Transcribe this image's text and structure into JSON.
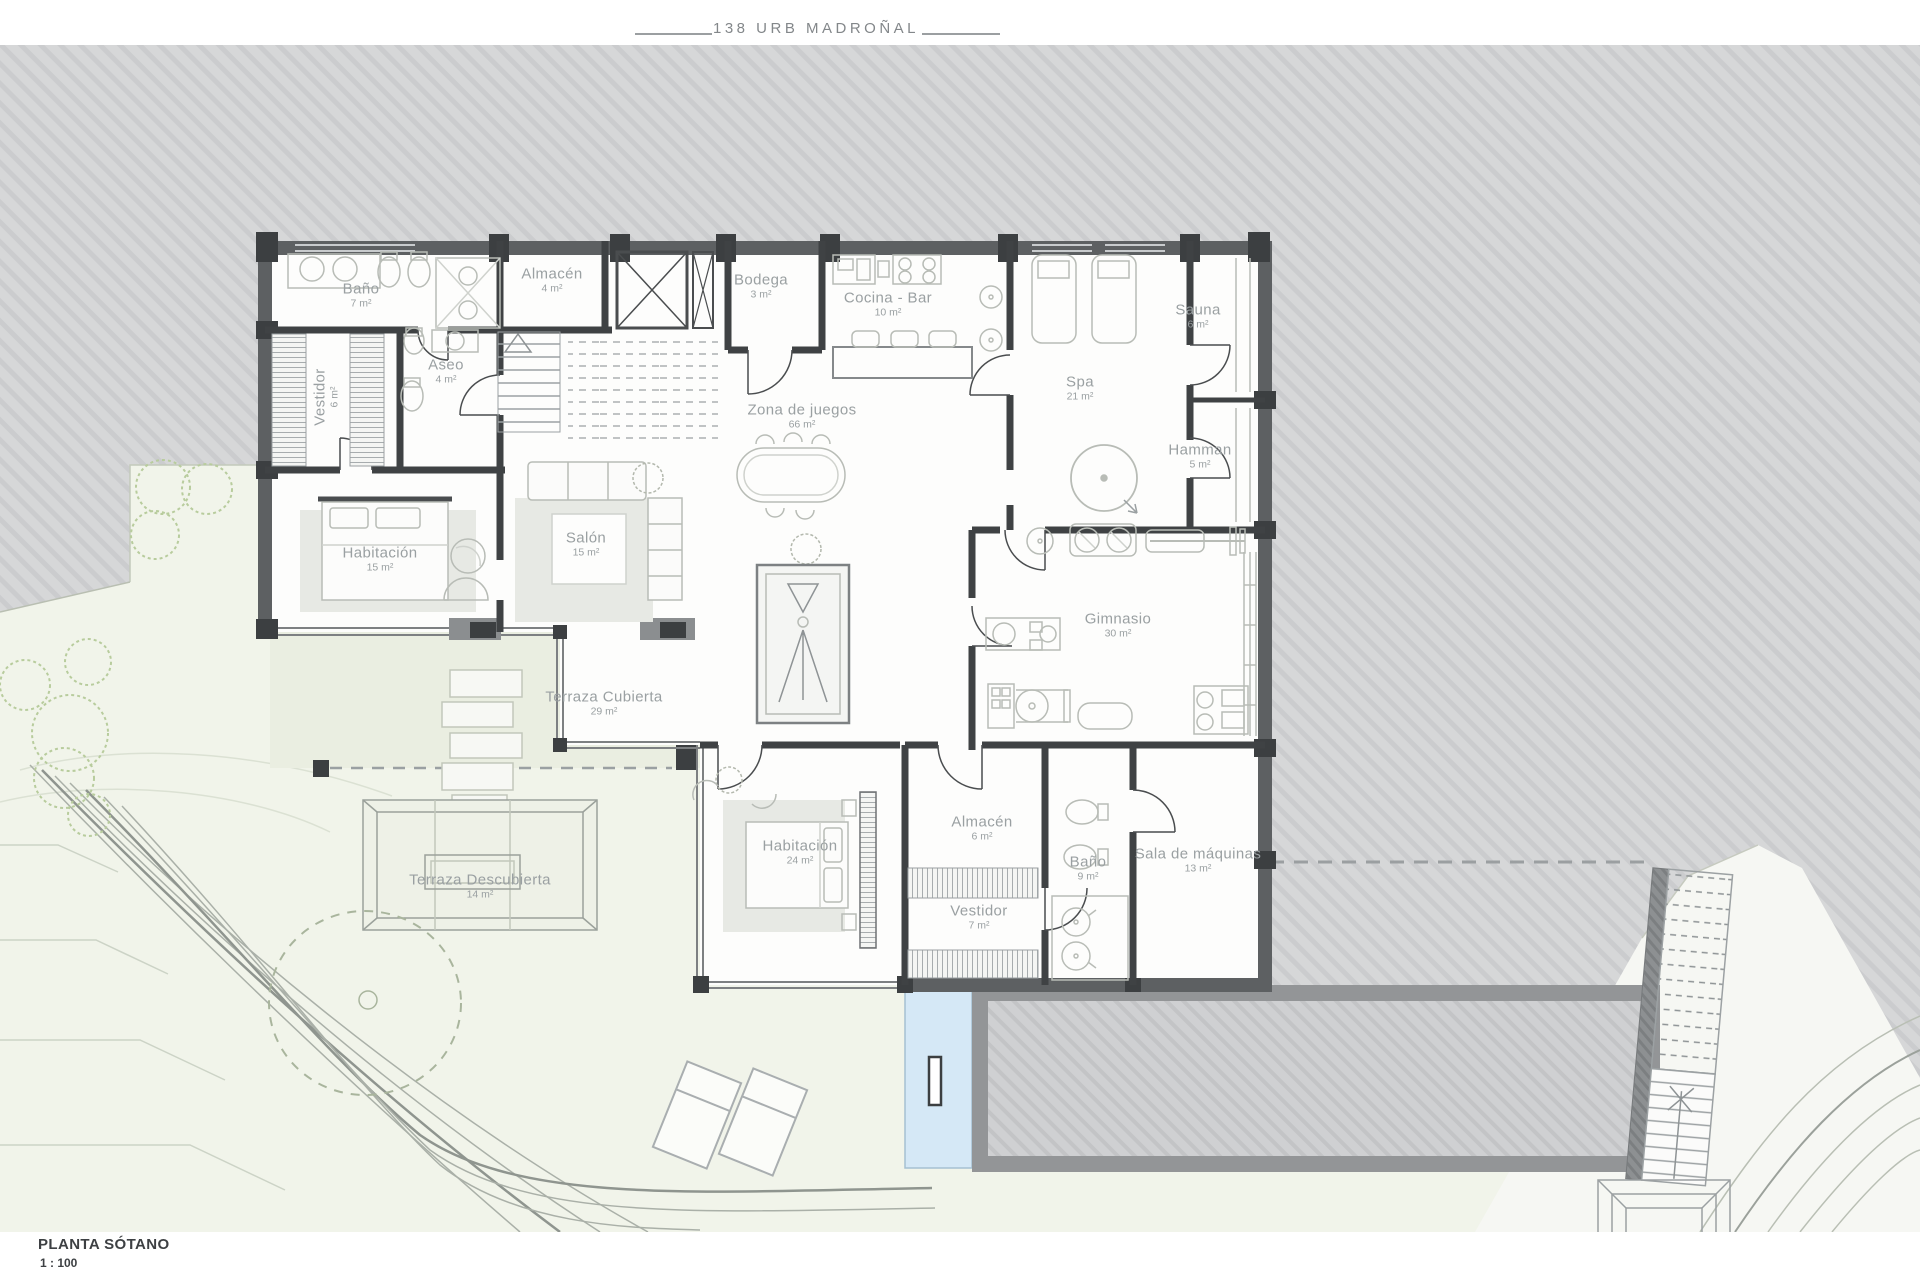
{
  "title": "138 URB MADROÑAL",
  "plan_label": {
    "name": "PLANTA SÓTANO",
    "scale": "1 : 100"
  },
  "rooms": [
    {
      "id": "bano-7",
      "name": "Baño",
      "area": "7 m²",
      "x": 361,
      "y": 296,
      "rotate": 0
    },
    {
      "id": "vestidor-6",
      "name": "Vestidor",
      "area": "6 m²",
      "x": 327,
      "y": 397,
      "rotate": -90
    },
    {
      "id": "aseo-4",
      "name": "Aseo",
      "area": "4 m²",
      "x": 446,
      "y": 372,
      "rotate": 0
    },
    {
      "id": "almacen-4",
      "name": "Almacén",
      "area": "4 m²",
      "x": 552,
      "y": 281,
      "rotate": 0
    },
    {
      "id": "bodega-3",
      "name": "Bodega",
      "area": "3 m²",
      "x": 761,
      "y": 287,
      "rotate": 0
    },
    {
      "id": "cocina-bar-10",
      "name": "Cocina - Bar",
      "area": "10 m²",
      "x": 888,
      "y": 305,
      "rotate": 0
    },
    {
      "id": "sauna-6",
      "name": "Sauna",
      "area": "6 m²",
      "x": 1198,
      "y": 317,
      "rotate": 0
    },
    {
      "id": "spa-21",
      "name": "Spa",
      "area": "21 m²",
      "x": 1080,
      "y": 389,
      "rotate": 0
    },
    {
      "id": "hamman-5",
      "name": "Hamman",
      "area": "5 m²",
      "x": 1200,
      "y": 457,
      "rotate": 0
    },
    {
      "id": "zona-de-juegos-66",
      "name": "Zona de juegos",
      "area": "66 m²",
      "x": 802,
      "y": 417,
      "rotate": 0
    },
    {
      "id": "habitacion-15",
      "name": "Habitación",
      "area": "15 m²",
      "x": 380,
      "y": 560,
      "rotate": 0
    },
    {
      "id": "salon-15",
      "name": "Salón",
      "area": "15 m²",
      "x": 586,
      "y": 545,
      "rotate": 0
    },
    {
      "id": "gimnasio-30",
      "name": "Gimnasio",
      "area": "30 m²",
      "x": 1118,
      "y": 626,
      "rotate": 0
    },
    {
      "id": "terraza-cubierta-29",
      "name": "Terraza Cubierta",
      "area": "29 m²",
      "x": 604,
      "y": 704,
      "rotate": 0
    },
    {
      "id": "terraza-descubierta-14",
      "name": "Terraza Descubierta",
      "area": "14 m²",
      "x": 480,
      "y": 887,
      "rotate": 0
    },
    {
      "id": "habitacion-24",
      "name": "Habitación",
      "area": "24 m²",
      "x": 800,
      "y": 853,
      "rotate": 0
    },
    {
      "id": "almacen-6",
      "name": "Almacén",
      "area": "6 m²",
      "x": 982,
      "y": 829,
      "rotate": 0
    },
    {
      "id": "bano-9",
      "name": "Baño",
      "area": "9 m²",
      "x": 1088,
      "y": 869,
      "rotate": 0
    },
    {
      "id": "vestidor-7",
      "name": "Vestidor",
      "area": "7 m²",
      "x": 979,
      "y": 918,
      "rotate": 0
    },
    {
      "id": "sala-de-maquinas-13",
      "name": "Sala de máquinas",
      "area": "13 m²",
      "x": 1198,
      "y": 861,
      "rotate": 0
    }
  ],
  "colors": {
    "c-terrain": "#d6d7d8",
    "c-garden": "#f1f4ea",
    "c-terrace": "#eaeee1",
    "c-cutland": "#f6f7f3",
    "c-pool": "#d5e8f6",
    "c-wall": "#5d6062",
    "c-label": "#9aa0a2",
    "c-title": "#83878a"
  }
}
